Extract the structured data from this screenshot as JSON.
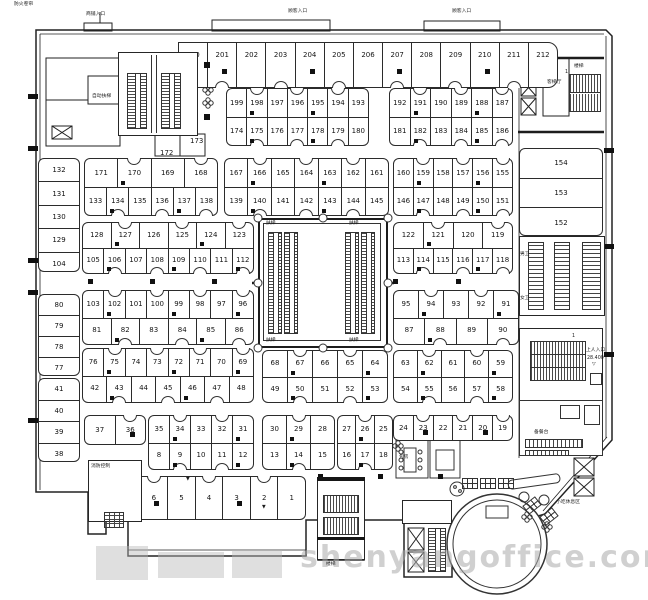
{
  "blocks": {
    "row1": {
      "cells": [
        "200",
        "201",
        "202",
        "203",
        "204",
        "205",
        "206",
        "207",
        "208",
        "209",
        "210",
        "211",
        "212"
      ]
    },
    "row2a": {
      "top": [
        "199",
        "198",
        "197",
        "196",
        "195",
        "194",
        "193"
      ],
      "bottom": [
        "174",
        "175",
        "176",
        "177",
        "178",
        "179",
        "180"
      ]
    },
    "row2b": {
      "top": [
        "192",
        "191",
        "190",
        "189",
        "188",
        "187"
      ],
      "bottom": [
        "181",
        "182",
        "183",
        "184",
        "185",
        "186"
      ]
    },
    "row3a": {
      "top": [
        "171",
        "170",
        "169",
        "168"
      ],
      "bottom": [
        "133",
        "134",
        "135",
        "136",
        "137",
        "138"
      ]
    },
    "row3c": {
      "top": [
        "167",
        "166",
        "165",
        "164",
        "163",
        "162",
        "161"
      ],
      "bottom": [
        "139",
        "140",
        "141",
        "142",
        "143",
        "144",
        "145"
      ]
    },
    "row3d": {
      "top": [
        "160",
        "159",
        "158",
        "157",
        "156",
        "155"
      ],
      "bottom": [
        "146",
        "147",
        "148",
        "149",
        "150",
        "151"
      ]
    },
    "row4a": {
      "top": [
        "128",
        "127",
        "126",
        "125",
        "124",
        "123"
      ],
      "bottom": [
        "105",
        "106",
        "107",
        "108",
        "109",
        "110",
        "111",
        "112"
      ]
    },
    "row4b": {
      "top": [
        "122",
        "121",
        "120",
        "119"
      ],
      "bottom": [
        "113",
        "114",
        "115",
        "116",
        "117",
        "118"
      ]
    },
    "row5a": {
      "top": [
        "103",
        "102",
        "101",
        "100",
        "99",
        "98",
        "97",
        "96"
      ],
      "bottom": [
        "81",
        "82",
        "83",
        "84",
        "85",
        "86"
      ]
    },
    "row5b": {
      "top": [
        "95",
        "94",
        "93",
        "92",
        "91"
      ],
      "bottom": [
        "87",
        "88",
        "89",
        "90"
      ]
    },
    "row6a": {
      "top": [
        "76",
        "75",
        "74",
        "73",
        "72",
        "71",
        "70",
        "69"
      ],
      "bottom": [
        "42",
        "43",
        "44",
        "45",
        "46",
        "47",
        "48"
      ]
    },
    "row6b": {
      "top": [
        "68",
        "67",
        "66",
        "65",
        "64"
      ],
      "bottom": [
        "49",
        "50",
        "51",
        "52",
        "53"
      ]
    },
    "row6c": {
      "top": [
        "63",
        "62",
        "61",
        "60",
        "59"
      ],
      "bottom": [
        "54",
        "55",
        "56",
        "57",
        "58"
      ]
    },
    "row7s": {
      "cells": [
        "37",
        "36"
      ]
    },
    "row7a": {
      "top": [
        "35",
        "34",
        "33",
        "32",
        "31"
      ],
      "bottom": [
        "8",
        "9",
        "10",
        "11",
        "12"
      ]
    },
    "row7b": {
      "top": [
        "30",
        "29",
        "28"
      ],
      "bottom": [
        "13",
        "14",
        "15"
      ]
    },
    "row7c": {
      "top": [
        "27",
        "26",
        "25"
      ],
      "bottom": [
        "16",
        "17",
        "18"
      ]
    },
    "row7d": {
      "cells": [
        "24",
        "23",
        "22",
        "21",
        "20",
        "19"
      ]
    },
    "bshops": {
      "cells": [
        "7",
        "6",
        "5",
        "4",
        "3",
        "2",
        "1"
      ]
    },
    "lc1": {
      "stack": [
        "132",
        "131",
        "130",
        "129",
        "104"
      ]
    },
    "lc2": {
      "stack": [
        "80",
        "79",
        "78",
        "77"
      ]
    },
    "lc3": {
      "stack": [
        "41",
        "40",
        "39",
        "38"
      ]
    },
    "rrooms": {
      "stack": [
        "154",
        "153",
        "152"
      ]
    }
  },
  "labels": {
    "fire_shutter": "防火卷帘",
    "shop_entrance": "商铺入口",
    "customer_entrance": "顾客入口",
    "escalator": "自动扶梯",
    "esc_short": "扶梯",
    "lift_hall": "客梯厅",
    "stairs": "楼梯",
    "upper_entry": "上人入口",
    "level": "28.400",
    "wc_male": "男卫",
    "wc_female": "女卫",
    "fire_control": "消防控制",
    "pantry": "备餐台",
    "snack_area": "小吃休息区",
    "room": "包房",
    "unit_172": "172",
    "unit_173": "173",
    "num_one": "1",
    "tri_down": "▼",
    "tri_open": "▽"
  },
  "watermark": {
    "site": "shenyangoffice.com"
  },
  "colors": {
    "ink": "#262626",
    "watermark": "#aaaaaa"
  }
}
